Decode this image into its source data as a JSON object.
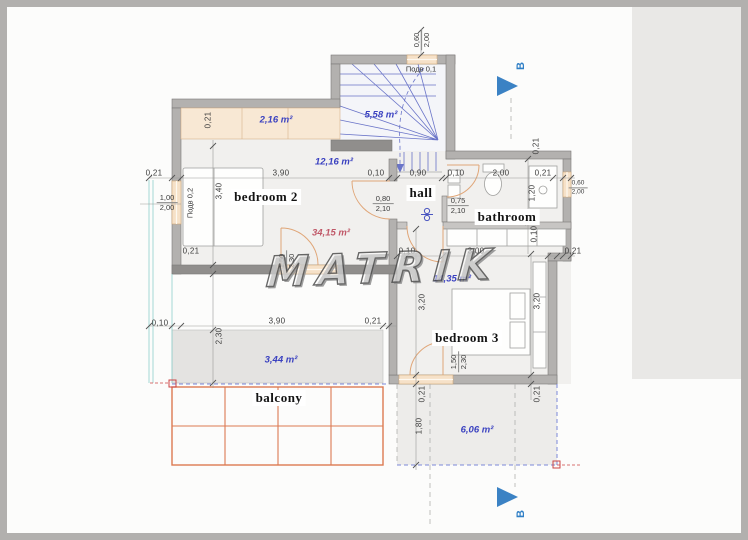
{
  "watermark": "MATRIK",
  "section_marker": {
    "top": "B",
    "bottom": "B"
  },
  "rooms": {
    "bedroom2": "bedroom 2",
    "hall": "hall",
    "bathroom": "bathroom",
    "bedroom3": "bedroom 3",
    "balcony": "balcony"
  },
  "areas": {
    "closet": "2,16 m²",
    "stairs": "5,58 m²",
    "bedroom2_zone": "12,16 m²",
    "level_total": "34,15 m²",
    "bedroom3": "14,35 m²",
    "roof_strip": "3,44 m²",
    "terrace": "6,06 m²"
  },
  "notes": {
    "stairs": "Подв 0,1",
    "left_window": "Подв 0,2"
  },
  "dims": {
    "row1_wall_l": "0,21",
    "row1_bedroom2": "3,90",
    "row1_partition1": "0,10",
    "row1_hall": "0,90",
    "row1_partition2": "0,10",
    "row1_bathroom": "2,00",
    "row1_wall_r": "0,21",
    "closet_depth": "0,21",
    "bath_top_wall": "0,21",
    "bedroom2_height": "3,40",
    "bath_right_seg": "1,20",
    "bath_wall_thick": "0,10",
    "left_wall_lower": "0,21",
    "row2_wall": "0,10",
    "row2_bedroom3": "3,00",
    "row2_wall_r": "0,21",
    "left_offset": "0,10",
    "strip_height": "2,30",
    "row3_bedroom2": "3,90",
    "row3_wall": "0,21",
    "bedroom3_height_l": "3,20",
    "bedroom3_height_r": "3,20",
    "bedroom3_wall_bl": "0,21",
    "bedroom3_wall_br": "0,21",
    "terrace_height": "1,80",
    "top_window": {
      "w": "0,60",
      "h": "2,00"
    },
    "left_window": {
      "w": "1,00",
      "h": "2,00"
    },
    "bath_window": {
      "w": "0,60",
      "h": "2,00"
    },
    "bedroom2_door": {
      "w": "0,80",
      "h": "2,10"
    },
    "bath_door": {
      "w": "0,75",
      "h": "2,10"
    },
    "bedroom2_window": {
      "w": "1,50",
      "h": "2,30"
    },
    "bedroom3_door": {
      "w": "1,50",
      "h": "2,30"
    }
  }
}
